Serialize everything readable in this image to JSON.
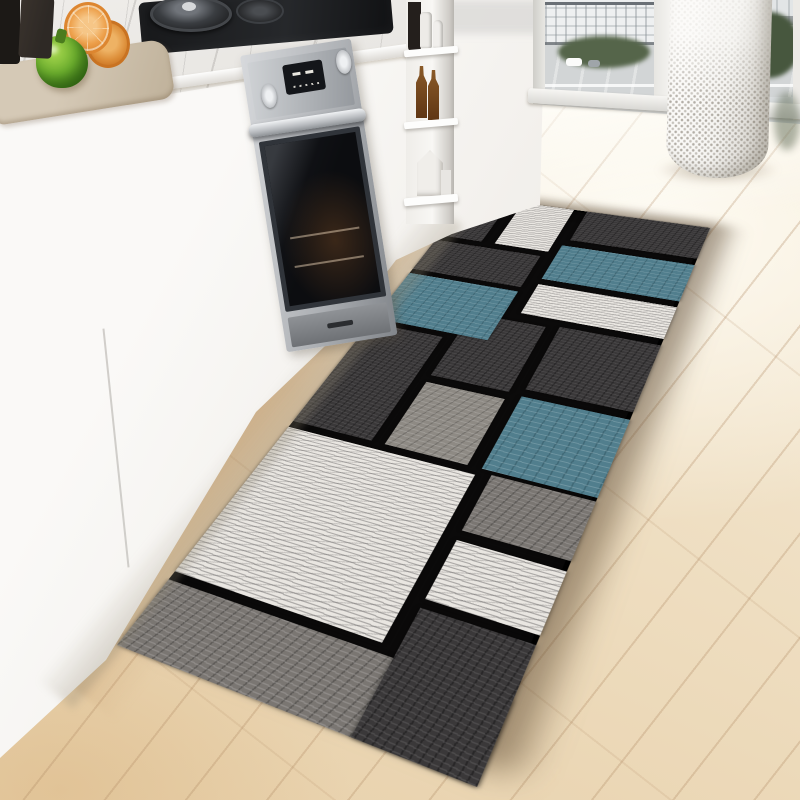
{
  "scene": {
    "type": "product-photo",
    "subject": "geometric patchwork kitchen runner rug on wooden floor in modern white kitchen"
  },
  "palette": {
    "floor_hi": "#f8f0df",
    "floor_mid": "#efdfc3",
    "floor_low": "#e7cfa8",
    "cab_white": "#faf9f7",
    "cab_white2": "#efece7",
    "cab_shade": "#ddd8d0",
    "seam": "#c9c7c2",
    "marble": "#efedea",
    "board": "#d5c9b6",
    "board_dark": "#bfb19a",
    "pepper": "#6cae2e",
    "pepper_dark": "#3f7d1a",
    "pepper_light": "#a8d84e",
    "orange": "#eda04b",
    "orange_rind": "#dd8630",
    "orange_light": "#f6c687",
    "bottle_dark": "#1c1916",
    "grinder": "#2e2925",
    "pan": "#202123",
    "pan_lid": "#70747a",
    "steel_light": "#d7d9dc",
    "steel": "#aeb1b5",
    "steel_dark": "#82868b",
    "display": "#14161a",
    "door": "#0c0d10",
    "door_frame": "#30343a",
    "bottle_amber": "#8a5a28",
    "glass_hi": "#eceeef",
    "glass_lo": "#d5d9db",
    "building": "#eef0f1",
    "building2": "#e2e5e6",
    "plaza": "#d2d5d6",
    "skyline": "#6a7076",
    "tree": "#55654a",
    "tree_dark": "#47573e",
    "car_white": "#fbfbfa",
    "frame_white": "#f4f3f0",
    "frame_shade": "#d3d1cc",
    "basket": "#f6f5f2",
    "basket_shade": "#d6d3cd",
    "rug_black": "#0b0a0a",
    "rug_dark": "#3a3839",
    "rug_teal": "#517e8d",
    "rug_white": "#e9e6e1",
    "rug_gray": "#7a7672",
    "rug_graymed": "#8e8a84"
  },
  "rug": {
    "width": 660,
    "height": 218,
    "radius": 16,
    "transform": "matrix3d(1.0011,-0.4859,0,0.0009919, 1.3028,0.0763,0,-0.0007308, 0,0,1,0, 117,645,0,1)",
    "blocks": [
      {
        "x": 0,
        "y": 0,
        "w": 62,
        "h": 218,
        "c": "gray",
        "name": "near-end-band"
      },
      {
        "x": 0,
        "y": 150,
        "w": 106,
        "h": 68,
        "c": "dark",
        "name": "near-corner"
      },
      {
        "x": 70,
        "y": 0,
        "w": 170,
        "h": 140,
        "c": "white",
        "name": "big-white"
      },
      {
        "x": 114,
        "y": 150,
        "w": 58,
        "h": 68,
        "c": "white",
        "name": "white-stripe"
      },
      {
        "x": 182,
        "y": 150,
        "w": 62,
        "h": 68,
        "c": "gray",
        "name": "gray-stripe"
      },
      {
        "x": 248,
        "y": 0,
        "w": 152,
        "h": 62,
        "c": "dark",
        "name": "mid-top-dark"
      },
      {
        "x": 248,
        "y": 72,
        "w": 86,
        "h": 60,
        "c": "graymed",
        "name": "center-gray"
      },
      {
        "x": 344,
        "y": 72,
        "w": 100,
        "h": 60,
        "c": "dark",
        "name": "center-dark-small"
      },
      {
        "x": 248,
        "y": 142,
        "w": 94,
        "h": 76,
        "c": "teal",
        "name": "center-teal"
      },
      {
        "x": 352,
        "y": 142,
        "w": 96,
        "h": 76,
        "c": "dark",
        "name": "mid-dark-low"
      },
      {
        "x": 408,
        "y": 0,
        "w": 84,
        "h": 96,
        "c": "teal",
        "name": "teal-cabinet-side"
      },
      {
        "x": 500,
        "y": 0,
        "w": 60,
        "h": 96,
        "c": "dark",
        "name": "dark-col-top"
      },
      {
        "x": 458,
        "y": 108,
        "w": 52,
        "h": 110,
        "c": "white",
        "name": "white-mid-far"
      },
      {
        "x": 520,
        "y": 108,
        "w": 66,
        "h": 110,
        "c": "teal",
        "name": "teal-viewer-side"
      },
      {
        "x": 570,
        "y": 0,
        "w": 90,
        "h": 40,
        "c": "dark",
        "name": "far-top-dark"
      },
      {
        "x": 570,
        "y": 52,
        "w": 90,
        "h": 48,
        "c": "white",
        "name": "far-white-small"
      },
      {
        "x": 598,
        "y": 112,
        "w": 62,
        "h": 106,
        "c": "dark",
        "name": "far-corner-dark"
      }
    ]
  }
}
